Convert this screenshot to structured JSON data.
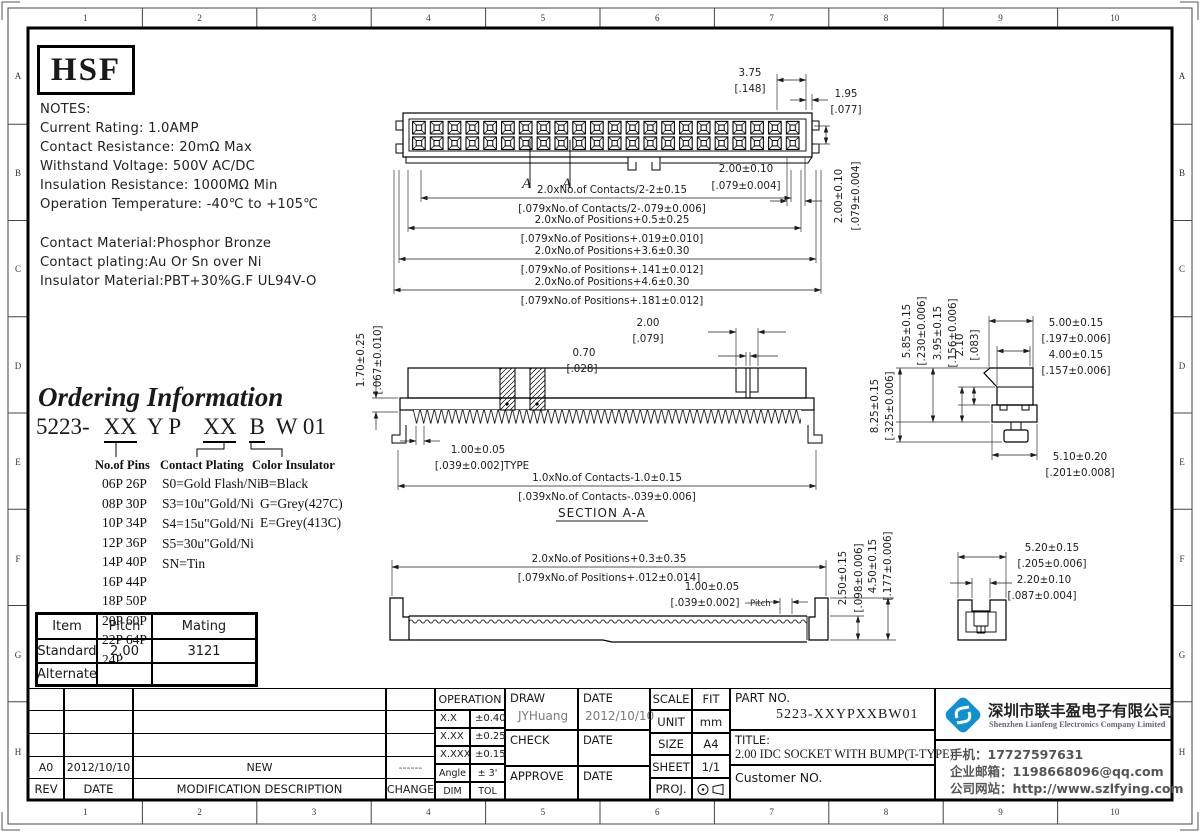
{
  "border": {
    "cols": [
      "1",
      "2",
      "3",
      "4",
      "5",
      "6",
      "7",
      "8",
      "9",
      "10"
    ],
    "rows": [
      "A",
      "B",
      "C",
      "D",
      "E",
      "F",
      "G",
      "H"
    ]
  },
  "logo_text": "HSF",
  "notes": {
    "title": "NOTES:",
    "lines": [
      "Current Rating: 1.0AMP",
      "Contact Resistance: 20mΩ Max",
      "Withstand Voltage: 500V AC/DC",
      "Insulation Resistance: 1000MΩ Min",
      "Operation Temperature: -40℃ to +105℃"
    ],
    "material_lines": [
      "Contact Material:Phosphor Bronze",
      "Contact plating:Au Or Sn over Ni",
      "Insulator Material:PBT+30%G.F UL94V-O"
    ]
  },
  "ordering": {
    "title": "Ordering Information",
    "code": {
      "prefix": "5223-",
      "pins": "XX",
      "mid": "Y P",
      "plating": "XX",
      "color": "B",
      "suffix": "W 01"
    },
    "pins_header": "No.of Pins",
    "pins": [
      "06P 26P",
      "08P 30P",
      "10P 34P",
      "12P 36P",
      "14P 40P",
      "16P 44P",
      "18P 50P",
      "20P 60P",
      "22P 64P",
      "24P"
    ],
    "plating_header": "Contact Plating",
    "plating": [
      "S0=Gold Flash/Ni",
      "S3=10u\"Gold/Ni",
      "S4=15u\"Gold/Ni",
      "S5=30u\"Gold/Ni",
      "SN=Tin"
    ],
    "color_header": "Color Insulator",
    "colors": [
      "B=Black",
      "G=Grey(427C)",
      "E=Grey(413C)"
    ]
  },
  "mating_table": {
    "headers": [
      "Item",
      "Pitch",
      "Mating"
    ],
    "row_standard": [
      "Standard",
      "2.00",
      "3121"
    ],
    "row_alternate": [
      "Alternate",
      "",
      ""
    ]
  },
  "dims": {
    "d375": "3.75",
    "d375b": "[.148]",
    "d195": "1.95",
    "d195b": "[.077]",
    "d200t": "2.00±0.10",
    "d200tb": "[.079±0.004]",
    "c1": "2.0xNo.of Contacts/2-2±0.15",
    "c2": "[.079xNo.of Contacts/2-.079±0.006]",
    "p1": "2.0xNo.of Positions+0.5±0.25",
    "p2": "[.079xNo.of Positions+.019±0.010]",
    "p3": "2.0xNo.of Positions+3.6±0.30",
    "p4": "[.079xNo.of Positions+.141±0.012]",
    "p5": "2.0xNo.of Positions+4.6±0.30",
    "p6": "[.079xNo.of Positions+.181±0.012]",
    "marker": "A",
    "s170": "1.70±0.25",
    "s170b": "[.067±0.010]",
    "s070": "0.70",
    "s070b": "[.028]",
    "s200": "2.00",
    "s200b": "[.079]",
    "s100": "1.00±0.05",
    "s100b": "[.039±0.002]TYPE",
    "s5": "1.0xNo.of Contacts-1.0±0.15",
    "s6": "[.039xNo.of Contacts-.039±0.006]",
    "section": "SECTION A-A",
    "r585": "5.85±0.15",
    "r585b": "[.230±0.006]",
    "r395": "3.95±0.15",
    "r395b": "[.156±0.006]",
    "r210": "2.10",
    "r210b": "[.083]",
    "r825": "8.25±0.15",
    "r825b": "[.325±0.006]",
    "r500": "5.00±0.15",
    "r500b": "[.197±0.006]",
    "r400": "4.00±0.15",
    "r400b": "[.157±0.006]",
    "r510": "5.10±0.20",
    "r510b": "[.201±0.008]",
    "b1": "2.0xNo.of Positions+0.3±0.35",
    "b2": "[.079xNo.of Positions+.012±0.014]",
    "b100": "1.00±0.05",
    "b100b": "[.039±0.002]",
    "pitch": "Pitch",
    "b250": "2.50±0.15",
    "b250b": "[.098±0.006]",
    "b450": "4.50±0.15",
    "b450b": "[.177±0.006]",
    "q520": "5.20±0.15",
    "q520b": "[.205±0.006]",
    "q220": "2.20±0.10",
    "q220b": "[.087±0.004]"
  },
  "revision": {
    "row": [
      "A0",
      "2012/10/10",
      "NEW",
      "------"
    ],
    "headers": [
      "REV",
      "DATE",
      "MODIFICATION  DESCRIPTION",
      "CHANGE"
    ]
  },
  "operation": {
    "header": "OPERATION",
    "rows": [
      [
        "X.X",
        "±0.40"
      ],
      [
        "X.XX",
        "±0.25"
      ],
      [
        "X.XXX",
        "±0.15"
      ],
      [
        "Angle",
        "± 3'"
      ],
      [
        "DIM",
        "TOL"
      ]
    ]
  },
  "signoff": {
    "draw_label": "DRAW",
    "draw_value": "JYHuang",
    "date_label": "DATE",
    "draw_date_value": "2012/10/10",
    "check_label": "CHECK",
    "approve_label": "APPROVE"
  },
  "meta": {
    "scale_label": "SCALE",
    "scale": "FIT",
    "unit_label": "UNIT",
    "unit": "mm",
    "size_label": "SIZE",
    "size": "A4",
    "sheet_label": "SHEET",
    "sheet": "1/1",
    "proj_label": "PROJ."
  },
  "part": {
    "part_no_label": "PART NO.",
    "part_no": "5223-XXYPXXBW01",
    "title_label": "TITLE:",
    "title": "2.00 IDC SOCKET WITH BUMP(T-TYPE)",
    "customer_label": "Customer NO."
  },
  "company": {
    "name_cn": "深圳市联丰盈电子有限公司",
    "name_en": "Shenzhen Lianfeng Electronics Company Limited",
    "phone": "手机：17727597631",
    "email": "企业邮箱：1198668096@qq.com",
    "website": "公司网站：http://www.szlfying.com",
    "brand_blue": "#1090d0"
  }
}
